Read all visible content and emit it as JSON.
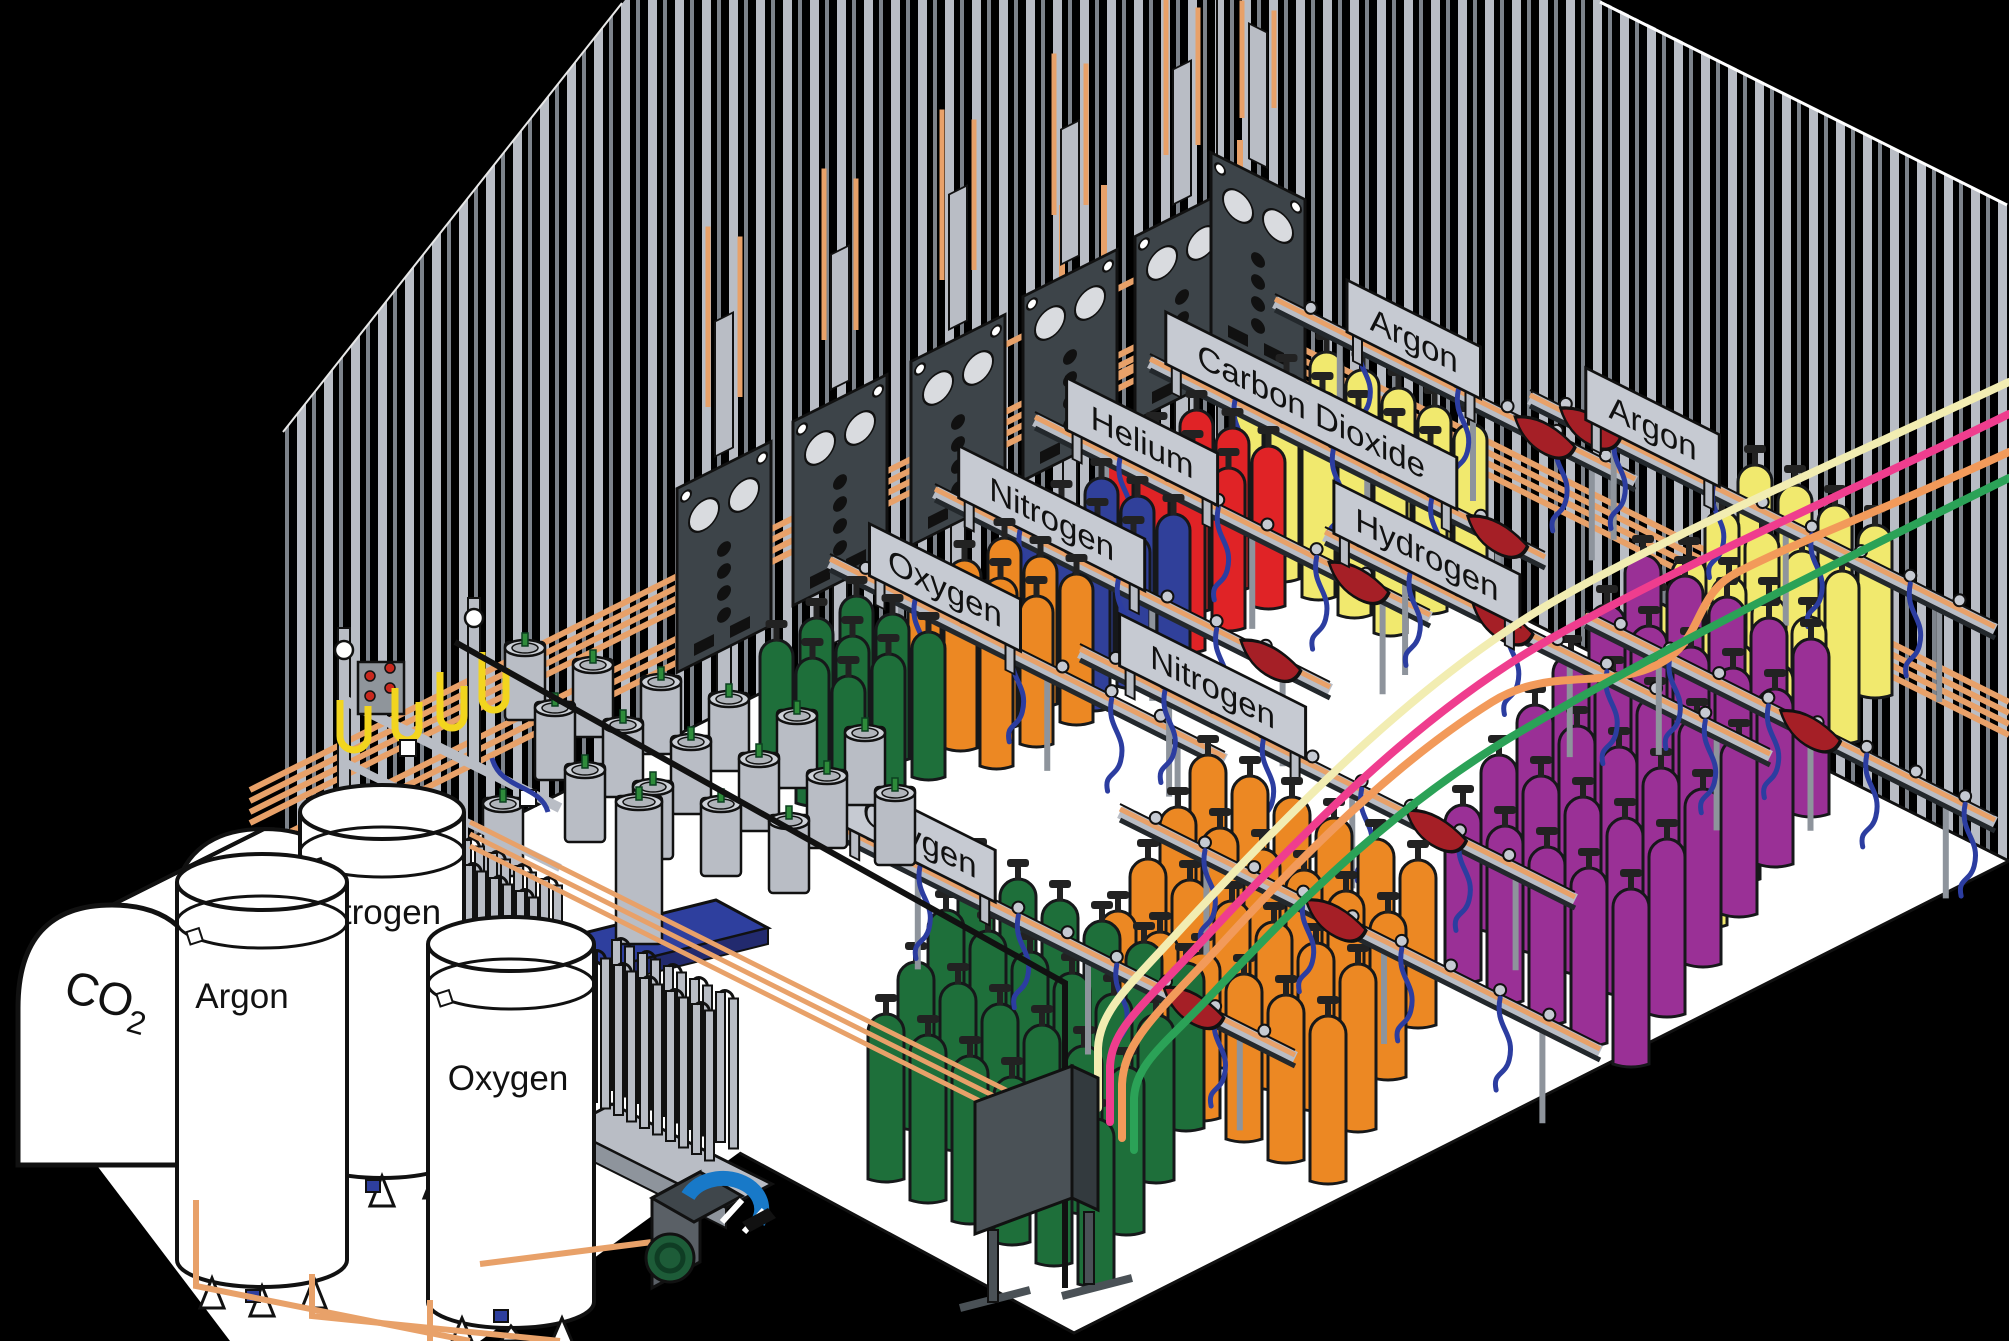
{
  "scene": {
    "width": 2009,
    "height": 1341,
    "description": "Isometric industrial gas cylinder filling plant"
  },
  "colors": {
    "background": "#000000",
    "floor": "#ffffff",
    "wall_stripe_light": "#b9bdc5",
    "wall_stripe_dim": "#7d838b",
    "copper_pipe": "#e8a169",
    "rail_gray": "#b9bdc5",
    "rail_dark": "#23282c",
    "sign_gray": "#c6cad2",
    "panel_dark": "#3d4449",
    "hose_blue": "#2c3da0",
    "pigtail_yellow": "#f2d51e",
    "dewar_gray": "#b9bdc5",
    "valve_green": "#2e8b3a",
    "pallet_blue": "#2e3f9e",
    "drip_tray_red": "#a51f26",
    "pump_blue": "#1879c8",
    "pump_green": "#1d5c38",
    "outline": "#111111"
  },
  "signs": [
    {
      "label": "Oxygen"
    },
    {
      "label": "Nitrogen"
    },
    {
      "label": "Helium"
    },
    {
      "label": "Carbon Dioxide"
    },
    {
      "label": "Argon"
    },
    {
      "label": "Argon"
    },
    {
      "label": "Hydrogen"
    },
    {
      "label": "Nitrogen"
    },
    {
      "label": "Oxygen"
    }
  ],
  "tanks": [
    {
      "label": "Argon"
    },
    {
      "label": "Nitrogen"
    },
    {
      "label": "Oxygen"
    }
  ],
  "co2_tank": {
    "label_main": "CO",
    "label_sub": "2"
  },
  "cylinder_groups": [
    {
      "name": "yellow-back",
      "color": "#f1e96e",
      "x": 1310,
      "y": 352,
      "cols": 5,
      "rows": 3,
      "adx": 36,
      "ady": 18,
      "rdx": -40,
      "rdy": 22,
      "w": 33,
      "h": 165
    },
    {
      "name": "red-back",
      "color": "#e02326",
      "x": 1180,
      "y": 410,
      "cols": 3,
      "rows": 3,
      "adx": 36,
      "ady": 18,
      "rdx": -40,
      "rdy": 22,
      "w": 33,
      "h": 160
    },
    {
      "name": "blue-back",
      "color": "#30409a",
      "x": 1085,
      "y": 478,
      "cols": 3,
      "rows": 3,
      "adx": 36,
      "ady": 18,
      "rdx": -40,
      "rdy": 22,
      "w": 33,
      "h": 150
    },
    {
      "name": "orange-back",
      "color": "#ec8823",
      "x": 988,
      "y": 538,
      "cols": 3,
      "rows": 3,
      "adx": 36,
      "ady": 18,
      "rdx": -40,
      "rdy": 22,
      "w": 33,
      "h": 148
    },
    {
      "name": "green-back",
      "color": "#1e6f3a",
      "x": 840,
      "y": 596,
      "cols": 3,
      "rows": 3,
      "adx": 36,
      "ady": 18,
      "rdx": -40,
      "rdy": 22,
      "w": 33,
      "h": 145
    },
    {
      "name": "yellow-right",
      "color": "#f1e96e",
      "x": 1738,
      "y": 465,
      "cols": 4,
      "rows": 6,
      "adx": 40,
      "ady": 20,
      "rdx": -33,
      "rdy": 46,
      "w": 34,
      "h": 170
    },
    {
      "name": "purple",
      "color": "#9a3096",
      "x": 1625,
      "y": 555,
      "cols": 5,
      "rows": 6,
      "adx": 42,
      "ady": 21,
      "rdx": -36,
      "rdy": 50,
      "w": 36,
      "h": 175
    },
    {
      "name": "orange-front",
      "color": "#ec8823",
      "x": 1190,
      "y": 755,
      "cols": 6,
      "rows": 4,
      "adx": 42,
      "ady": 21,
      "rdx": -30,
      "rdy": 52,
      "w": 36,
      "h": 165
    },
    {
      "name": "green-front",
      "color": "#1e6f3a",
      "x": 958,
      "y": 858,
      "cols": 6,
      "rows": 4,
      "adx": 42,
      "ady": 21,
      "rdx": -30,
      "rdy": 52,
      "w": 36,
      "h": 165
    }
  ],
  "tubes": [
    {
      "name": "cream-tube",
      "color": "#f2edb2"
    },
    {
      "name": "pink-tube",
      "color": "#ef3d8e"
    },
    {
      "name": "orange-tube",
      "color": "#f29a5a"
    },
    {
      "name": "green-tube",
      "color": "#2ba257"
    }
  ]
}
